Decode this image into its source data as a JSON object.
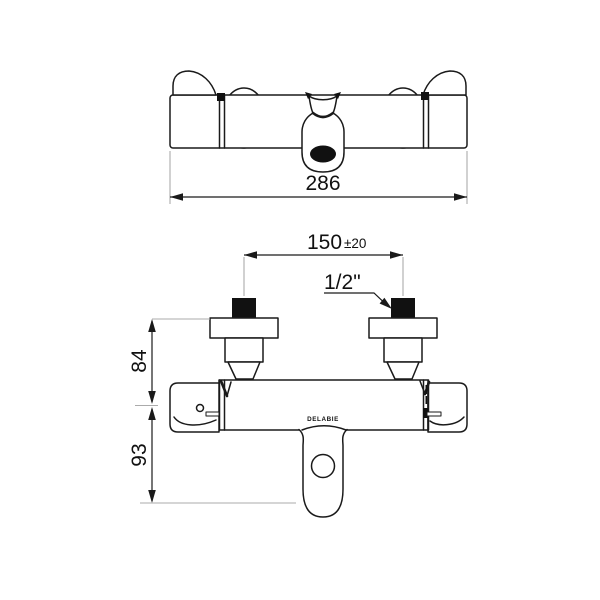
{
  "colors": {
    "line": "#1a1a1a",
    "guide_line": "#ababab",
    "background": "#ffffff"
  },
  "dims": {
    "overall_width": "286",
    "inlet_spacing": "150",
    "inlet_spacing_tol": "±20",
    "inlet_thread": "1/2\"",
    "wall_to_axis": "84",
    "axis_to_outlet": "93"
  },
  "labels": {
    "brand": "DELABIE"
  }
}
